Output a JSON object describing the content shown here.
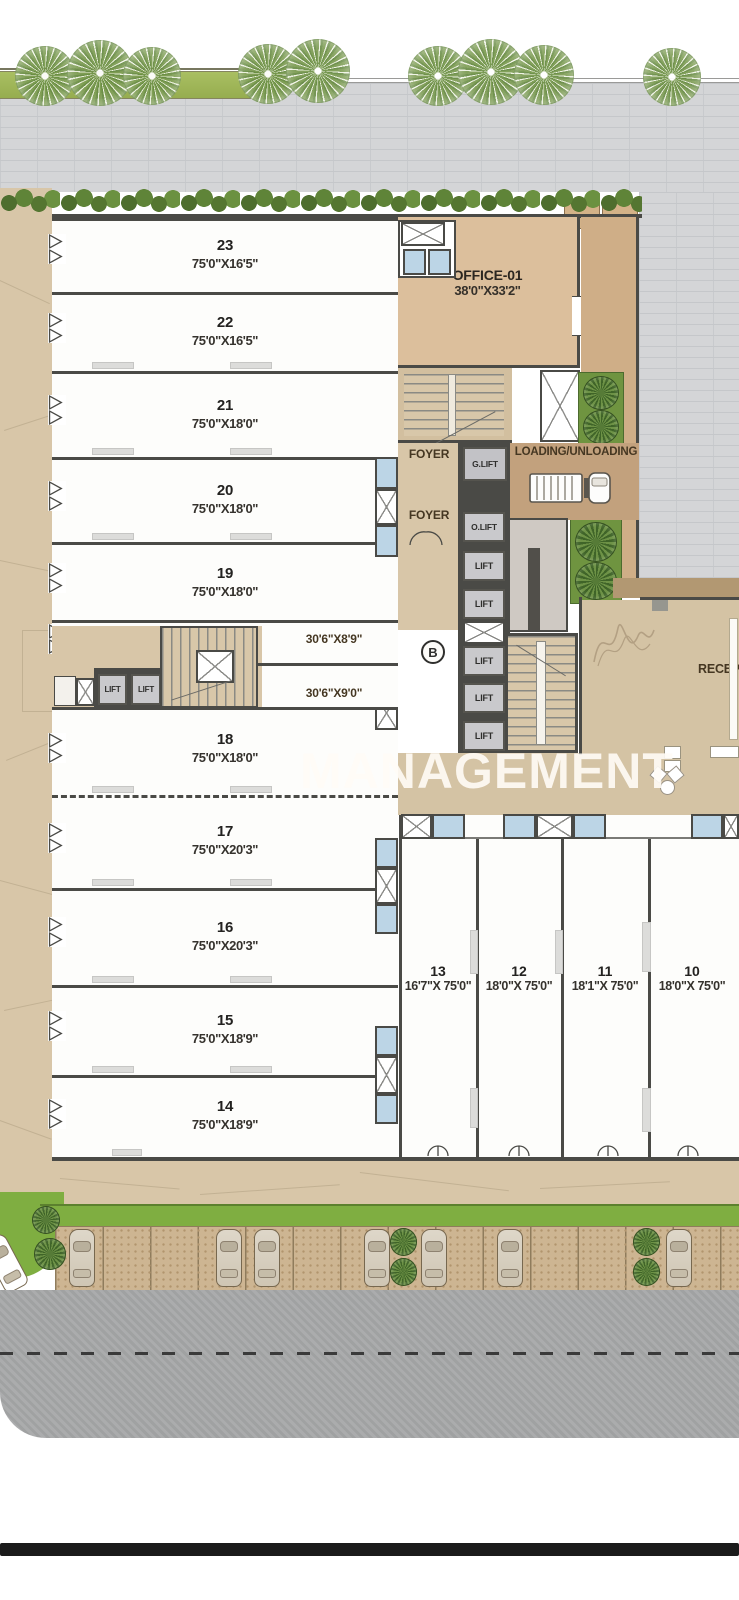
{
  "plan": {
    "watermark": "MANAGEMENT",
    "block_marker": "B",
    "office": {
      "name": "OFFICE-01",
      "dim": "38'0\"X33'2\""
    },
    "labels": {
      "foyer_upper": "FOYER",
      "foyer_lower": "FOYER",
      "g_lift": "G.LIFT",
      "o_lift": "O.LIFT",
      "lift": "LIFT",
      "loading": "LOADING/UNLOADING",
      "reception": "RECEPTION"
    },
    "corridor_rooms": {
      "upper_dim": "30'6\"X8'9\"",
      "lower_dim": "30'6\"X9'0\""
    },
    "units_left": [
      {
        "no": "23",
        "dim": "75'0\"X16'5\""
      },
      {
        "no": "22",
        "dim": "75'0\"X16'5\""
      },
      {
        "no": "21",
        "dim": "75'0\"X18'0\""
      },
      {
        "no": "20",
        "dim": "75'0\"X18'0\""
      },
      {
        "no": "19",
        "dim": "75'0\"X18'0\""
      },
      {
        "no": "18",
        "dim": "75'0\"X18'0\""
      },
      {
        "no": "17",
        "dim": "75'0\"X20'3\""
      },
      {
        "no": "16",
        "dim": "75'0\"X20'3\""
      },
      {
        "no": "15",
        "dim": "75'0\"X18'9\""
      },
      {
        "no": "14",
        "dim": "75'0\"X18'9\""
      }
    ],
    "units_bottom": [
      {
        "no": "13",
        "dim": "16'7\"X 75'0\""
      },
      {
        "no": "12",
        "dim": "18'0\"X 75'0\""
      },
      {
        "no": "11",
        "dim": "18'1\"X 75'0\""
      },
      {
        "no": "10",
        "dim": "18'0\"X 75'0\""
      }
    ],
    "colors": {
      "wall": "#4a4a46",
      "path_tan": "#d8c6a8",
      "office_tan": "#dcbf9c",
      "loading_brown": "#c2a17d",
      "reception_tan": "#d4c3a4",
      "grass": "#7fae41",
      "hedge_green": "#5f7f39",
      "paving_gray": "#d4d5d7",
      "road_gray": "#a7a8a9",
      "door_blue": "#bcd5e6",
      "lift_gray": "#c9c9cc"
    }
  }
}
